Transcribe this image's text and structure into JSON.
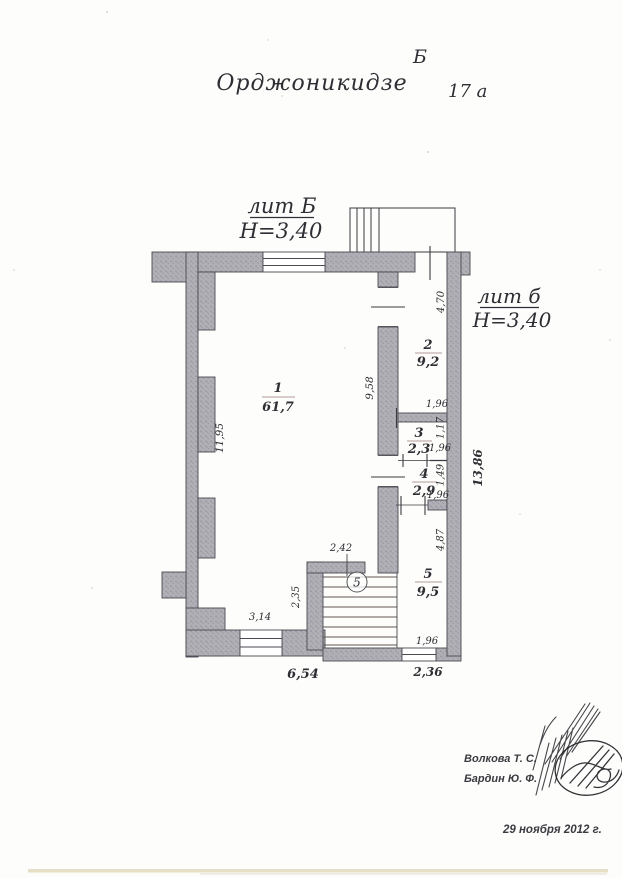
{
  "page": {
    "street_name": "Орджоникидзе",
    "building_letter": "Б",
    "house_number": "17 а"
  },
  "liters": {
    "main": {
      "label": "лит Б",
      "height": "Н=3,40"
    },
    "annex": {
      "label": "лит б",
      "height": "Н=3,40"
    }
  },
  "rooms": [
    {
      "number": "1",
      "area": "61,7"
    },
    {
      "number": "2",
      "area": "9,2"
    },
    {
      "number": "3",
      "area": "2,3"
    },
    {
      "number": "4",
      "area": "2,9"
    },
    {
      "number": "5",
      "area": "9,5"
    }
  ],
  "stair_marker": "5",
  "dimensions": {
    "room1_height": "11,95",
    "mid_wall": "9,58",
    "room2_height": "4,70",
    "room2_width": "1,96",
    "room3_height": "1,17",
    "room3_width": "1,96",
    "room4_height": "1,49",
    "room4_width": "1,96",
    "room5_height": "4,87",
    "room5_width": "1,96",
    "right_side_total": "13,86",
    "annex_bottom_width": "2,36",
    "stair_width": "2,42",
    "stair_depth": "2,35",
    "bottom_window": "3,14",
    "bottom_total": "6,54"
  },
  "footer": {
    "technician": "Волкова Т. С.",
    "engineer": "Бардин Ю. Ф.",
    "date": "29 ноября 2012 г."
  },
  "colors": {
    "wall_fill": "#b0afb6",
    "wall_stipple": "#8e8d96",
    "line": "#4a4a52",
    "ink": "#2e2e34",
    "paper": "#fdfdfb"
  }
}
